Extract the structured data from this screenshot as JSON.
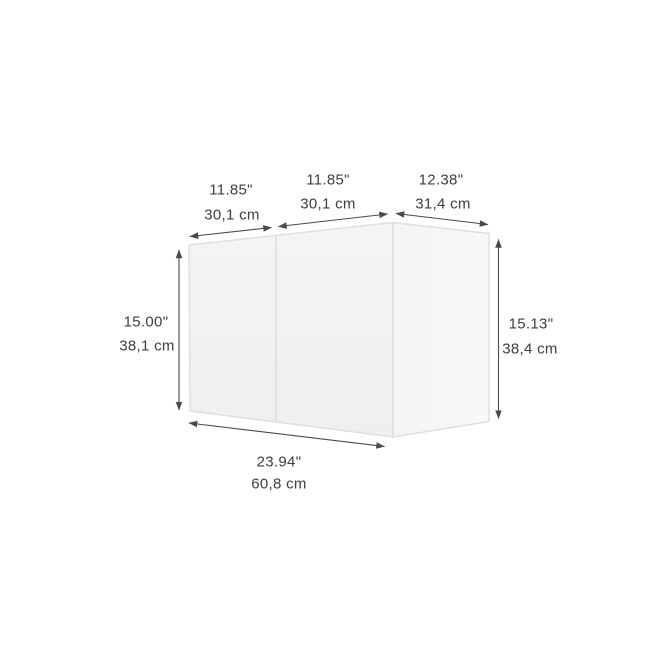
{
  "page": {
    "background": "#ffffff"
  },
  "diagram": {
    "kind": "product-dimension-drawing",
    "object": "wall-cabinet-two-doors",
    "colors": {
      "background": "#ffffff",
      "front_face": "#f1f1f1",
      "front_face_light": "#f5f5f5",
      "side_face": "#f7f7f7",
      "side_face_dark": "#f2f2f2",
      "edge": "#dedede",
      "dimension_line": "#4a4a4a",
      "label_text": "#3e3e3e"
    },
    "dimensions": {
      "top_left": {
        "inches": "11.85\"",
        "cm": "30,1 cm"
      },
      "top_middle": {
        "inches": "11.85\"",
        "cm": "30,1 cm"
      },
      "top_right": {
        "inches": "12.38\"",
        "cm": "31,4 cm"
      },
      "left": {
        "inches": "15.00\"",
        "cm": "38,1 cm"
      },
      "right": {
        "inches": "15.13\"",
        "cm": "38,4 cm"
      },
      "bottom": {
        "inches": "23.94\"",
        "cm": "60,8 cm"
      }
    }
  }
}
